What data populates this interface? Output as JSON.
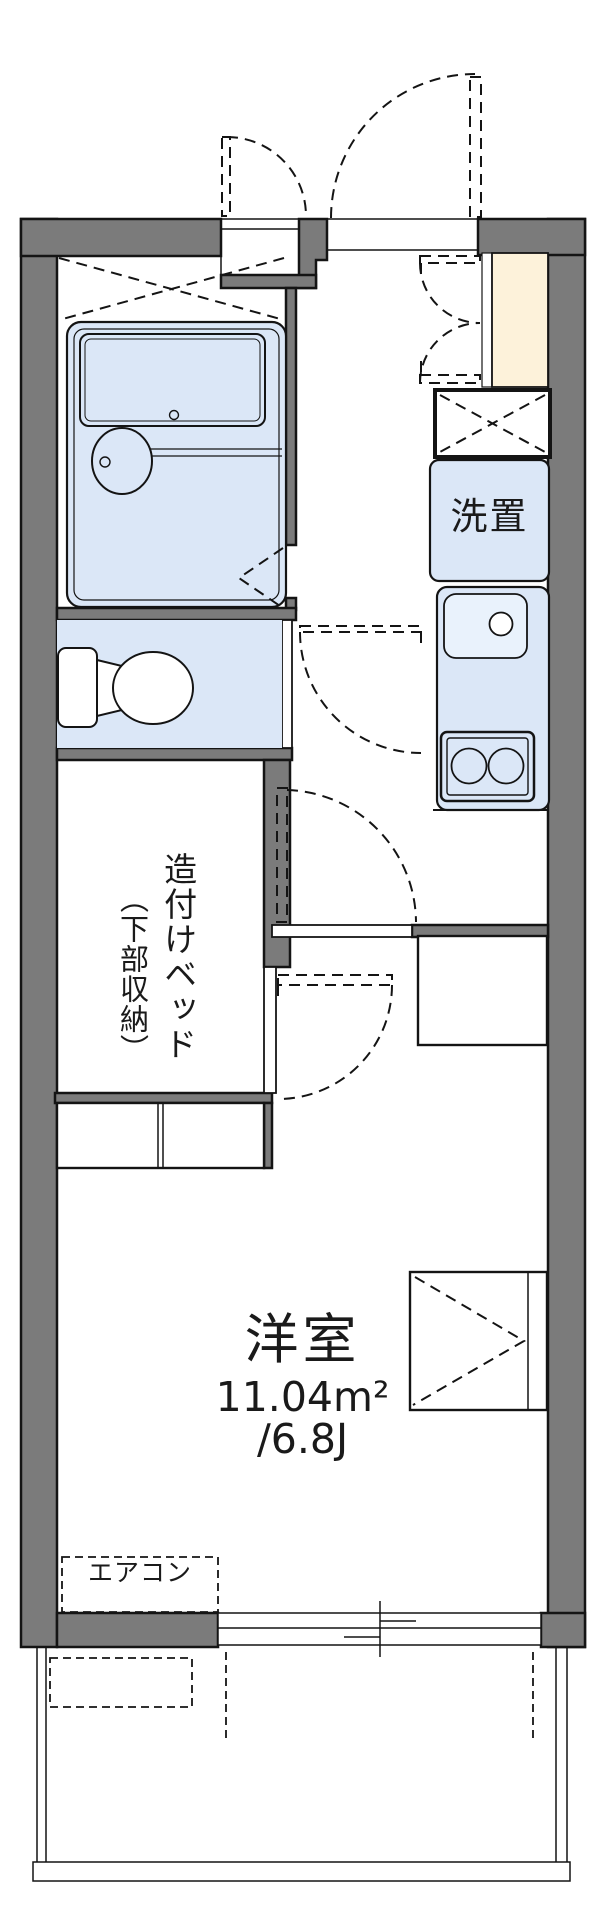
{
  "title": "apartment-floor-plan",
  "labels": {
    "laundry": "洗置",
    "bed_outer": "造付けベッド",
    "bed_inner": "（下部収納）",
    "room_name": "洋室",
    "room_area_m2": "11.04m²",
    "room_area_tatami": "/6.8J",
    "aircon": "エアコン"
  },
  "symbols": [
    "entrance-door-arc",
    "double-closet-door-arc",
    "shoe-cabinet",
    "overhead-storage-x-box",
    "bathtub",
    "bath-faucet",
    "bifold-bath-door",
    "toilet",
    "washing-machine-box",
    "kitchen-sink",
    "two-burner-stove",
    "refrigerator-box",
    "storage-triangle-box",
    "built-in-bed-counter",
    "sliding-window",
    "balcony-rail",
    "aircon-dashed-box"
  ],
  "colors": {
    "wall": "#7b7b7b",
    "fixture": "#dbe7f7",
    "fixture_light": "#e9f2fc",
    "cabinet": "#fdf2da",
    "line": "#141414"
  }
}
